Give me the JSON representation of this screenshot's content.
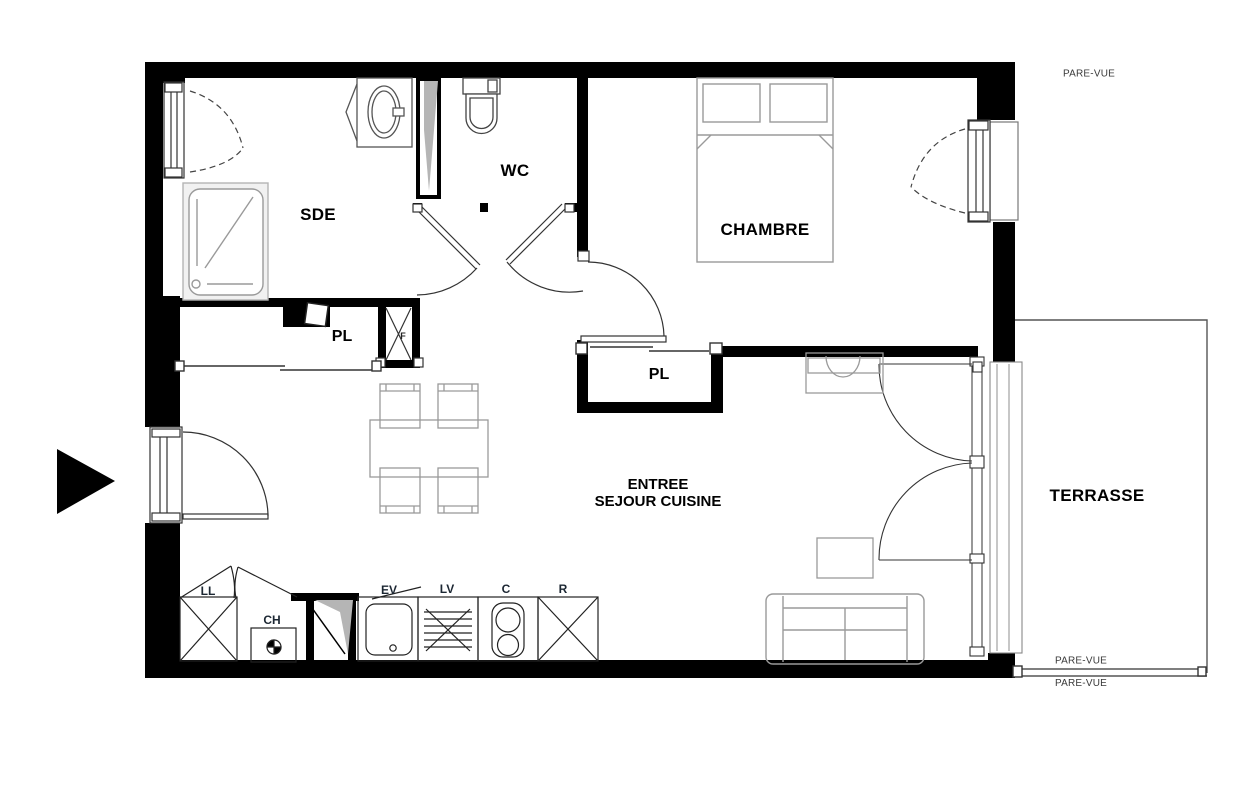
{
  "floorplan": {
    "rooms": {
      "sde": "SDE",
      "wc": "WC",
      "chambre": "CHAMBRE",
      "closet1": "PL",
      "closet2": "PL",
      "living_line1": "ENTREE",
      "living_line2": "SEJOUR CUISINE",
      "terrace": "TERRASSE"
    },
    "appliances": {
      "washing_machine": "LL",
      "water_heater": "CH",
      "kitchen_sink": "EV",
      "dishwasher": "LV",
      "cooktop": "C",
      "fridge": "R"
    },
    "annotations": {
      "privacy_screen_top": "PARE-VUE",
      "privacy_screen_bottom": "PARE-VUE",
      "privacy_screen_bottom_clipped": "PARE-VUE",
      "duct": "F"
    },
    "colors": {
      "wall": "#000000",
      "furniture_outline": "#9a9a9a",
      "fixture_outline": "#555555",
      "duct_shading": "#b5b5b5"
    }
  }
}
